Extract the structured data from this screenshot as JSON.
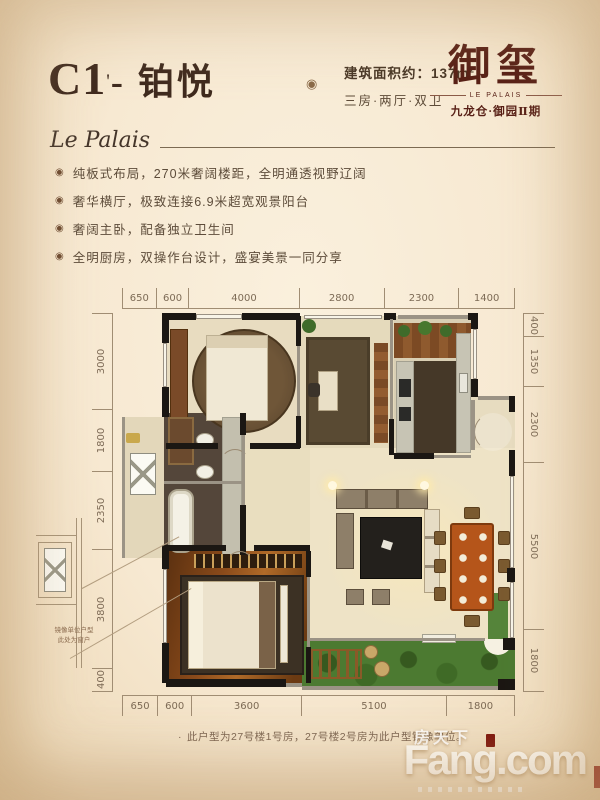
{
  "header": {
    "unit_code": "C1",
    "unit_sup": "'",
    "unit_rest": "- 铂悦",
    "ornament": "◉",
    "area_text": "建筑面积约：137m",
    "area_sup": "2",
    "layout_text": "三房·两厅·双卫"
  },
  "brand": {
    "logo_text": "御玺",
    "band_text": "LE PALAIS",
    "subtitle": "九龙仓·御园Ⅱ期",
    "script_text": "Le Palais"
  },
  "features": {
    "icon": "◉",
    "items": [
      "纯板式布局，270米奢阔楼距，全明通透视野辽阔",
      "奢华横厅，极致连接6.9米超宽观景阳台",
      "奢阔主卧，配备独立卫生间",
      "全明厨房，双操作台设计，盛宴美景一同分享"
    ]
  },
  "floorplan": {
    "dims_top": [
      650,
      600,
      4000,
      2800,
      2300,
      1400
    ],
    "dims_bottom": [
      650,
      600,
      3600,
      5100,
      1800
    ],
    "dims_left": [
      3000,
      1800,
      2350,
      3800,
      400
    ],
    "dims_right": [
      400,
      1350,
      2300,
      5500,
      1800
    ],
    "mirror_note_line1": "镜像单位户型",
    "mirror_note_line2": "此处为窗户"
  },
  "note": {
    "marker": "·",
    "text": "此户型为27号楼1号房，27号楼2号房为此户型镜像单位。"
  },
  "watermark": {
    "cn": "房天下",
    "en": "Fang.com"
  },
  "colors": {
    "accent_maroon": "#571f15",
    "title_brown": "#3f2a1e",
    "body_text": "#5d4c3a",
    "background_cream": "#f7e9d2",
    "wall_black": "#1b1713",
    "garden_green": "#4c7a31",
    "master_wood": "#8a4a1a",
    "dining_table": "#b5551a"
  }
}
